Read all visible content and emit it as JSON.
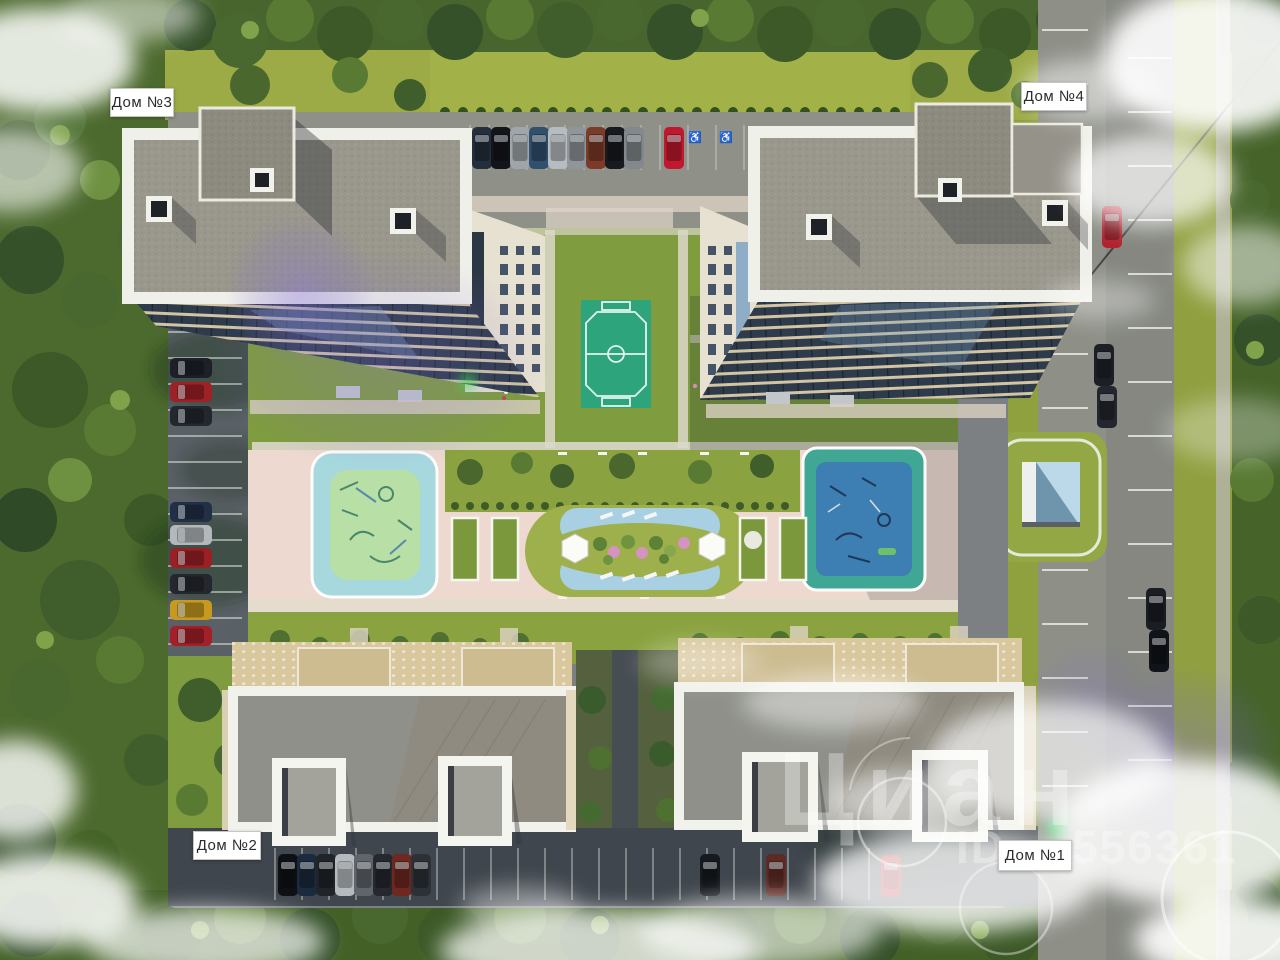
{
  "labels": {
    "house1": "Дом №1",
    "house2": "Дом №2",
    "house3": "Дом №3",
    "house4": "Дом №4"
  },
  "watermark": {
    "brand": "Циан",
    "id_label": "ID",
    "id_digits": "556361"
  },
  "icons": {
    "accessible_parking": "♿"
  },
  "colors": {
    "label_bg": "#ffffff",
    "label_text": "#2b2b2b",
    "forest_green": "#466428",
    "lawn_green": "#9aab44",
    "asphalt_light": "#8e9088",
    "asphalt_dark": "#3f464d",
    "roof_gray": "#9a978d",
    "parapet_white": "#f2f2ec",
    "plaza_pink": "#edd9cf",
    "field_green": "#2ea47c",
    "playground_blue": "#3d7fb2",
    "playground_cyan": "#a7d8de",
    "facade_beige": "#e8e2d2"
  }
}
